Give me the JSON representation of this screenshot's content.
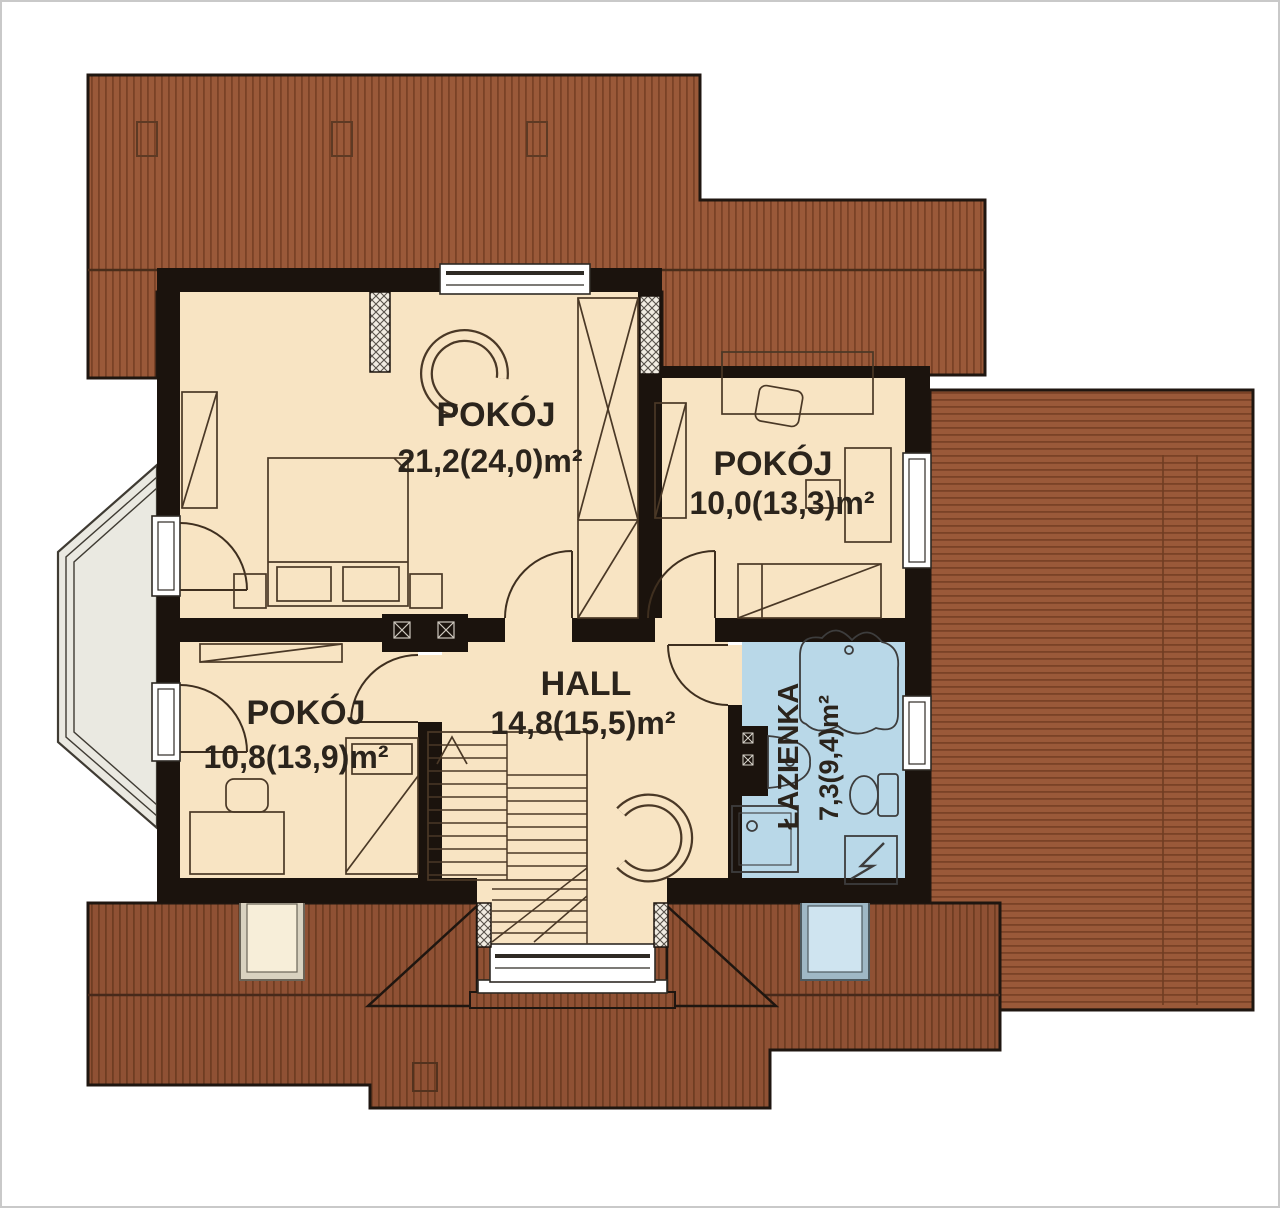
{
  "rooms": [
    {
      "name": "POKÓJ",
      "area": "21,2(24,0)m²"
    },
    {
      "name": "POKÓJ",
      "area": "10,0(13,3)m²"
    },
    {
      "name": "POKÓJ",
      "area": "10,8(13,9)m²"
    },
    {
      "name": "HALL",
      "area": "14,8(15,5)m²"
    },
    {
      "name": "ŁAZIENKA",
      "area": "7,3(9,4)m²"
    }
  ],
  "colors": {
    "roof": "#9a5939",
    "roof_stripe": "#7a4226",
    "roof_dark": "#8f5134",
    "roof_dark_stripe": "#6f3d22",
    "room_fill": "#f8e4c3",
    "bathroom_fill": "#b9d8e8",
    "wall": "#1b130d",
    "balcony_fill": "#eae9e1"
  }
}
